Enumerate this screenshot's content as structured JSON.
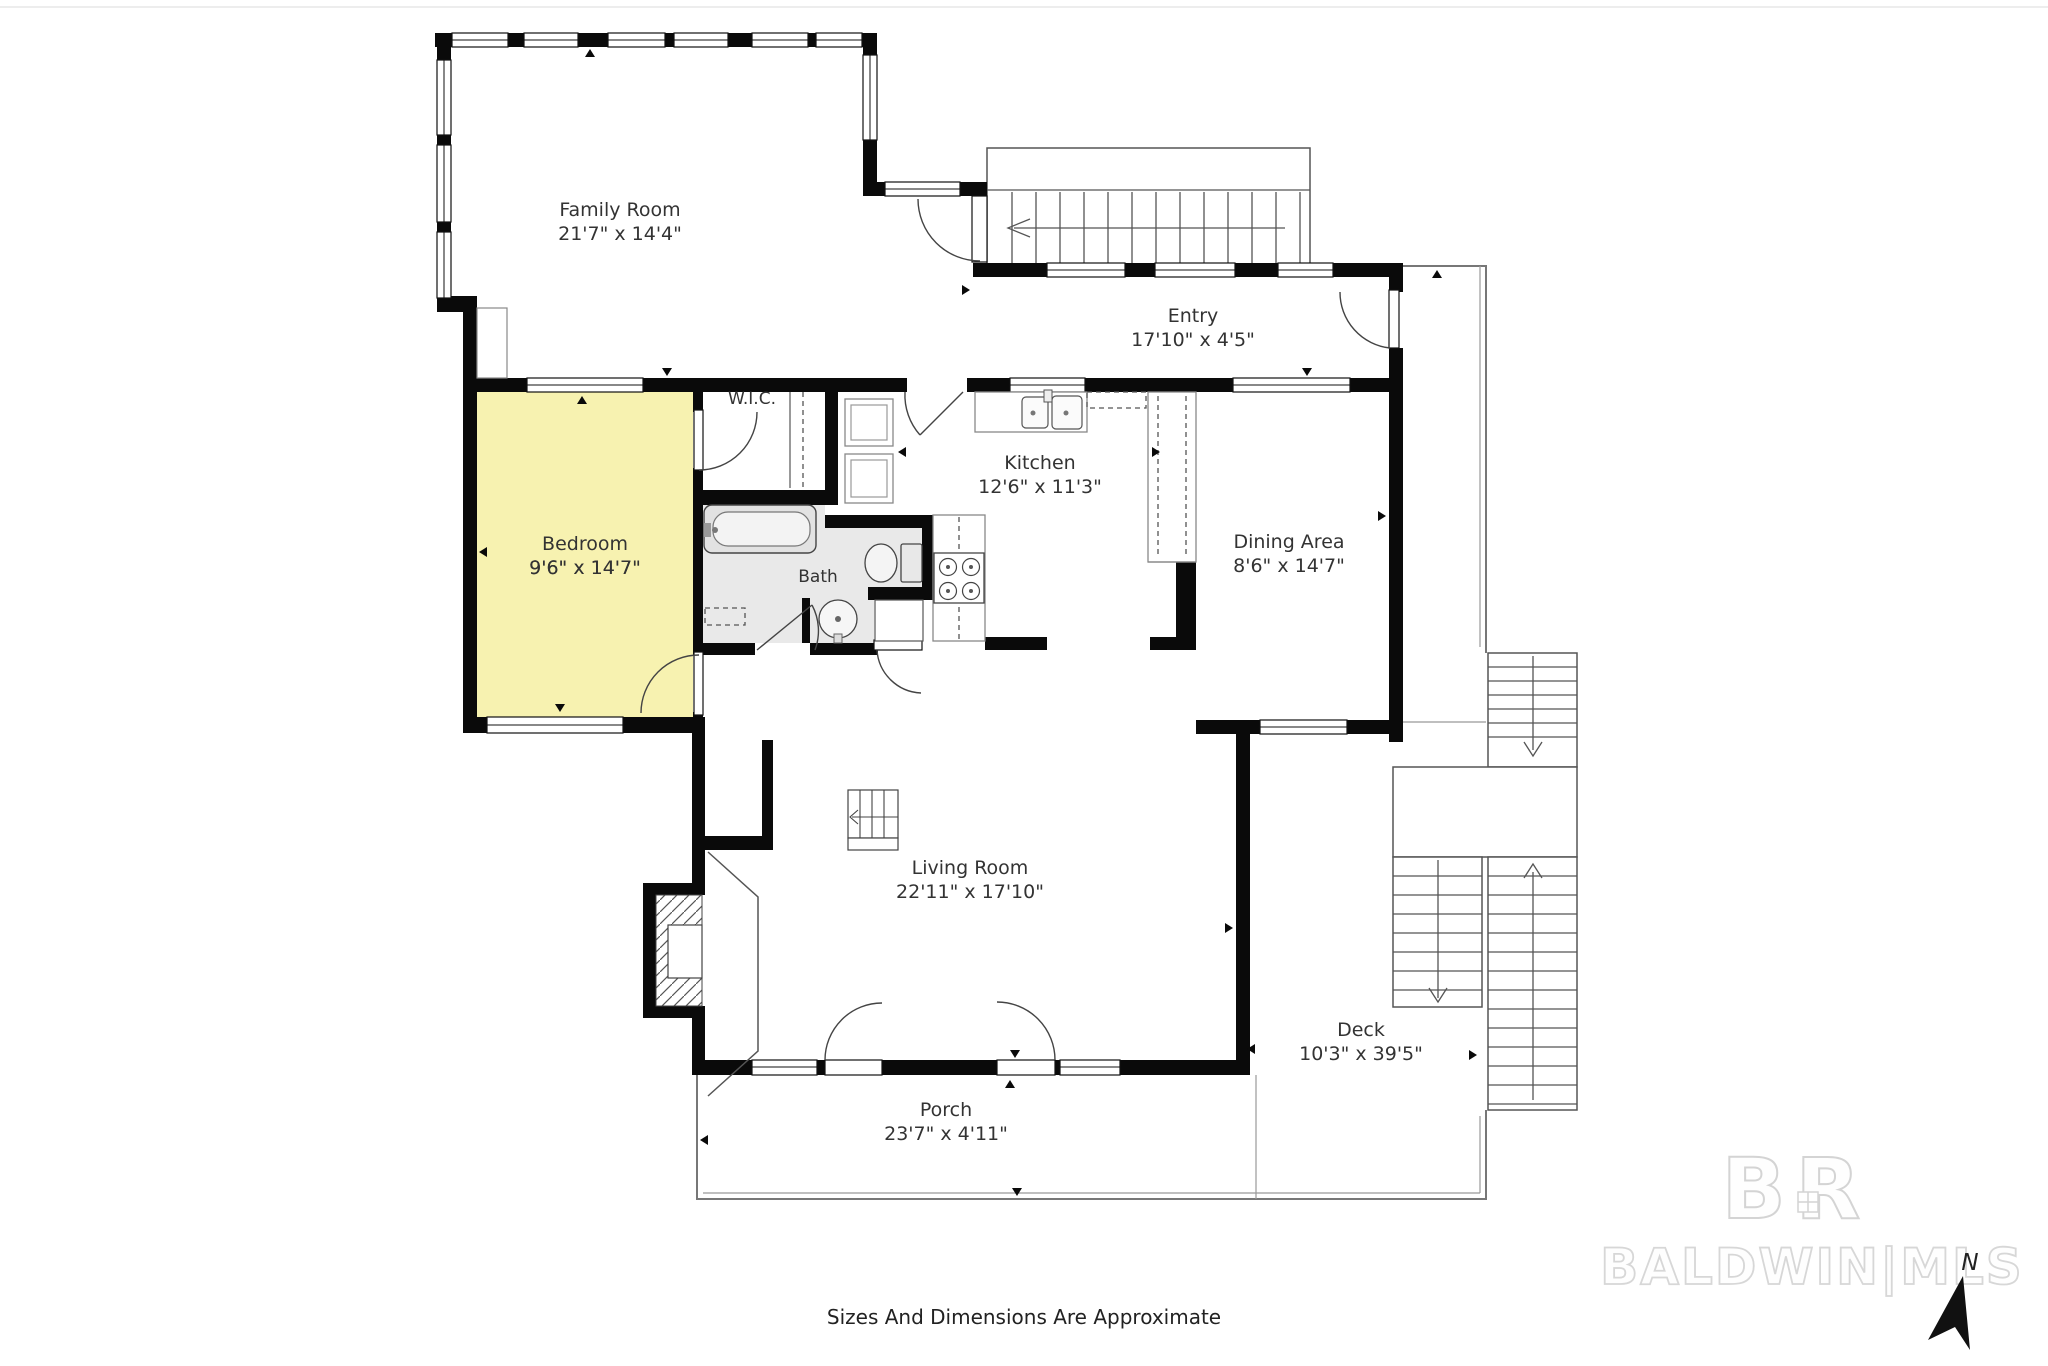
{
  "page": {
    "disclaimer": "Sizes And Dimensions Are Approximate"
  },
  "rooms": [
    {
      "id": "family-room",
      "name": "Family Room",
      "dims": "21'7\" x 14'4\""
    },
    {
      "id": "entry",
      "name": "Entry",
      "dims": "17'10\" x 4'5\""
    },
    {
      "id": "wic",
      "name": "W.I.C.",
      "dims": ""
    },
    {
      "id": "bedroom",
      "name": "Bedroom",
      "dims": "9'6\" x 14'7\""
    },
    {
      "id": "bath",
      "name": "Bath",
      "dims": ""
    },
    {
      "id": "kitchen",
      "name": "Kitchen",
      "dims": "12'6\" x 11'3\""
    },
    {
      "id": "dining-area",
      "name": "Dining Area",
      "dims": "8'6\" x 14'7\""
    },
    {
      "id": "living-room",
      "name": "Living Room",
      "dims": "22'11\" x 17'10\""
    },
    {
      "id": "porch",
      "name": "Porch",
      "dims": "23'7\" x 4'11\""
    },
    {
      "id": "deck",
      "name": "Deck",
      "dims": "10'3\" x 39'5\""
    }
  ],
  "watermark": {
    "monogram": "BR",
    "brand": "BALDWIN|MLS"
  },
  "compass": {
    "north_label": "N"
  },
  "colors": {
    "wall": "#0a0a0a",
    "bedroom_fill": "#f7f2b0",
    "bath_fill": "#e9e9e9",
    "label_text": "#333333",
    "watermark_gray": "#d6d6d6"
  }
}
